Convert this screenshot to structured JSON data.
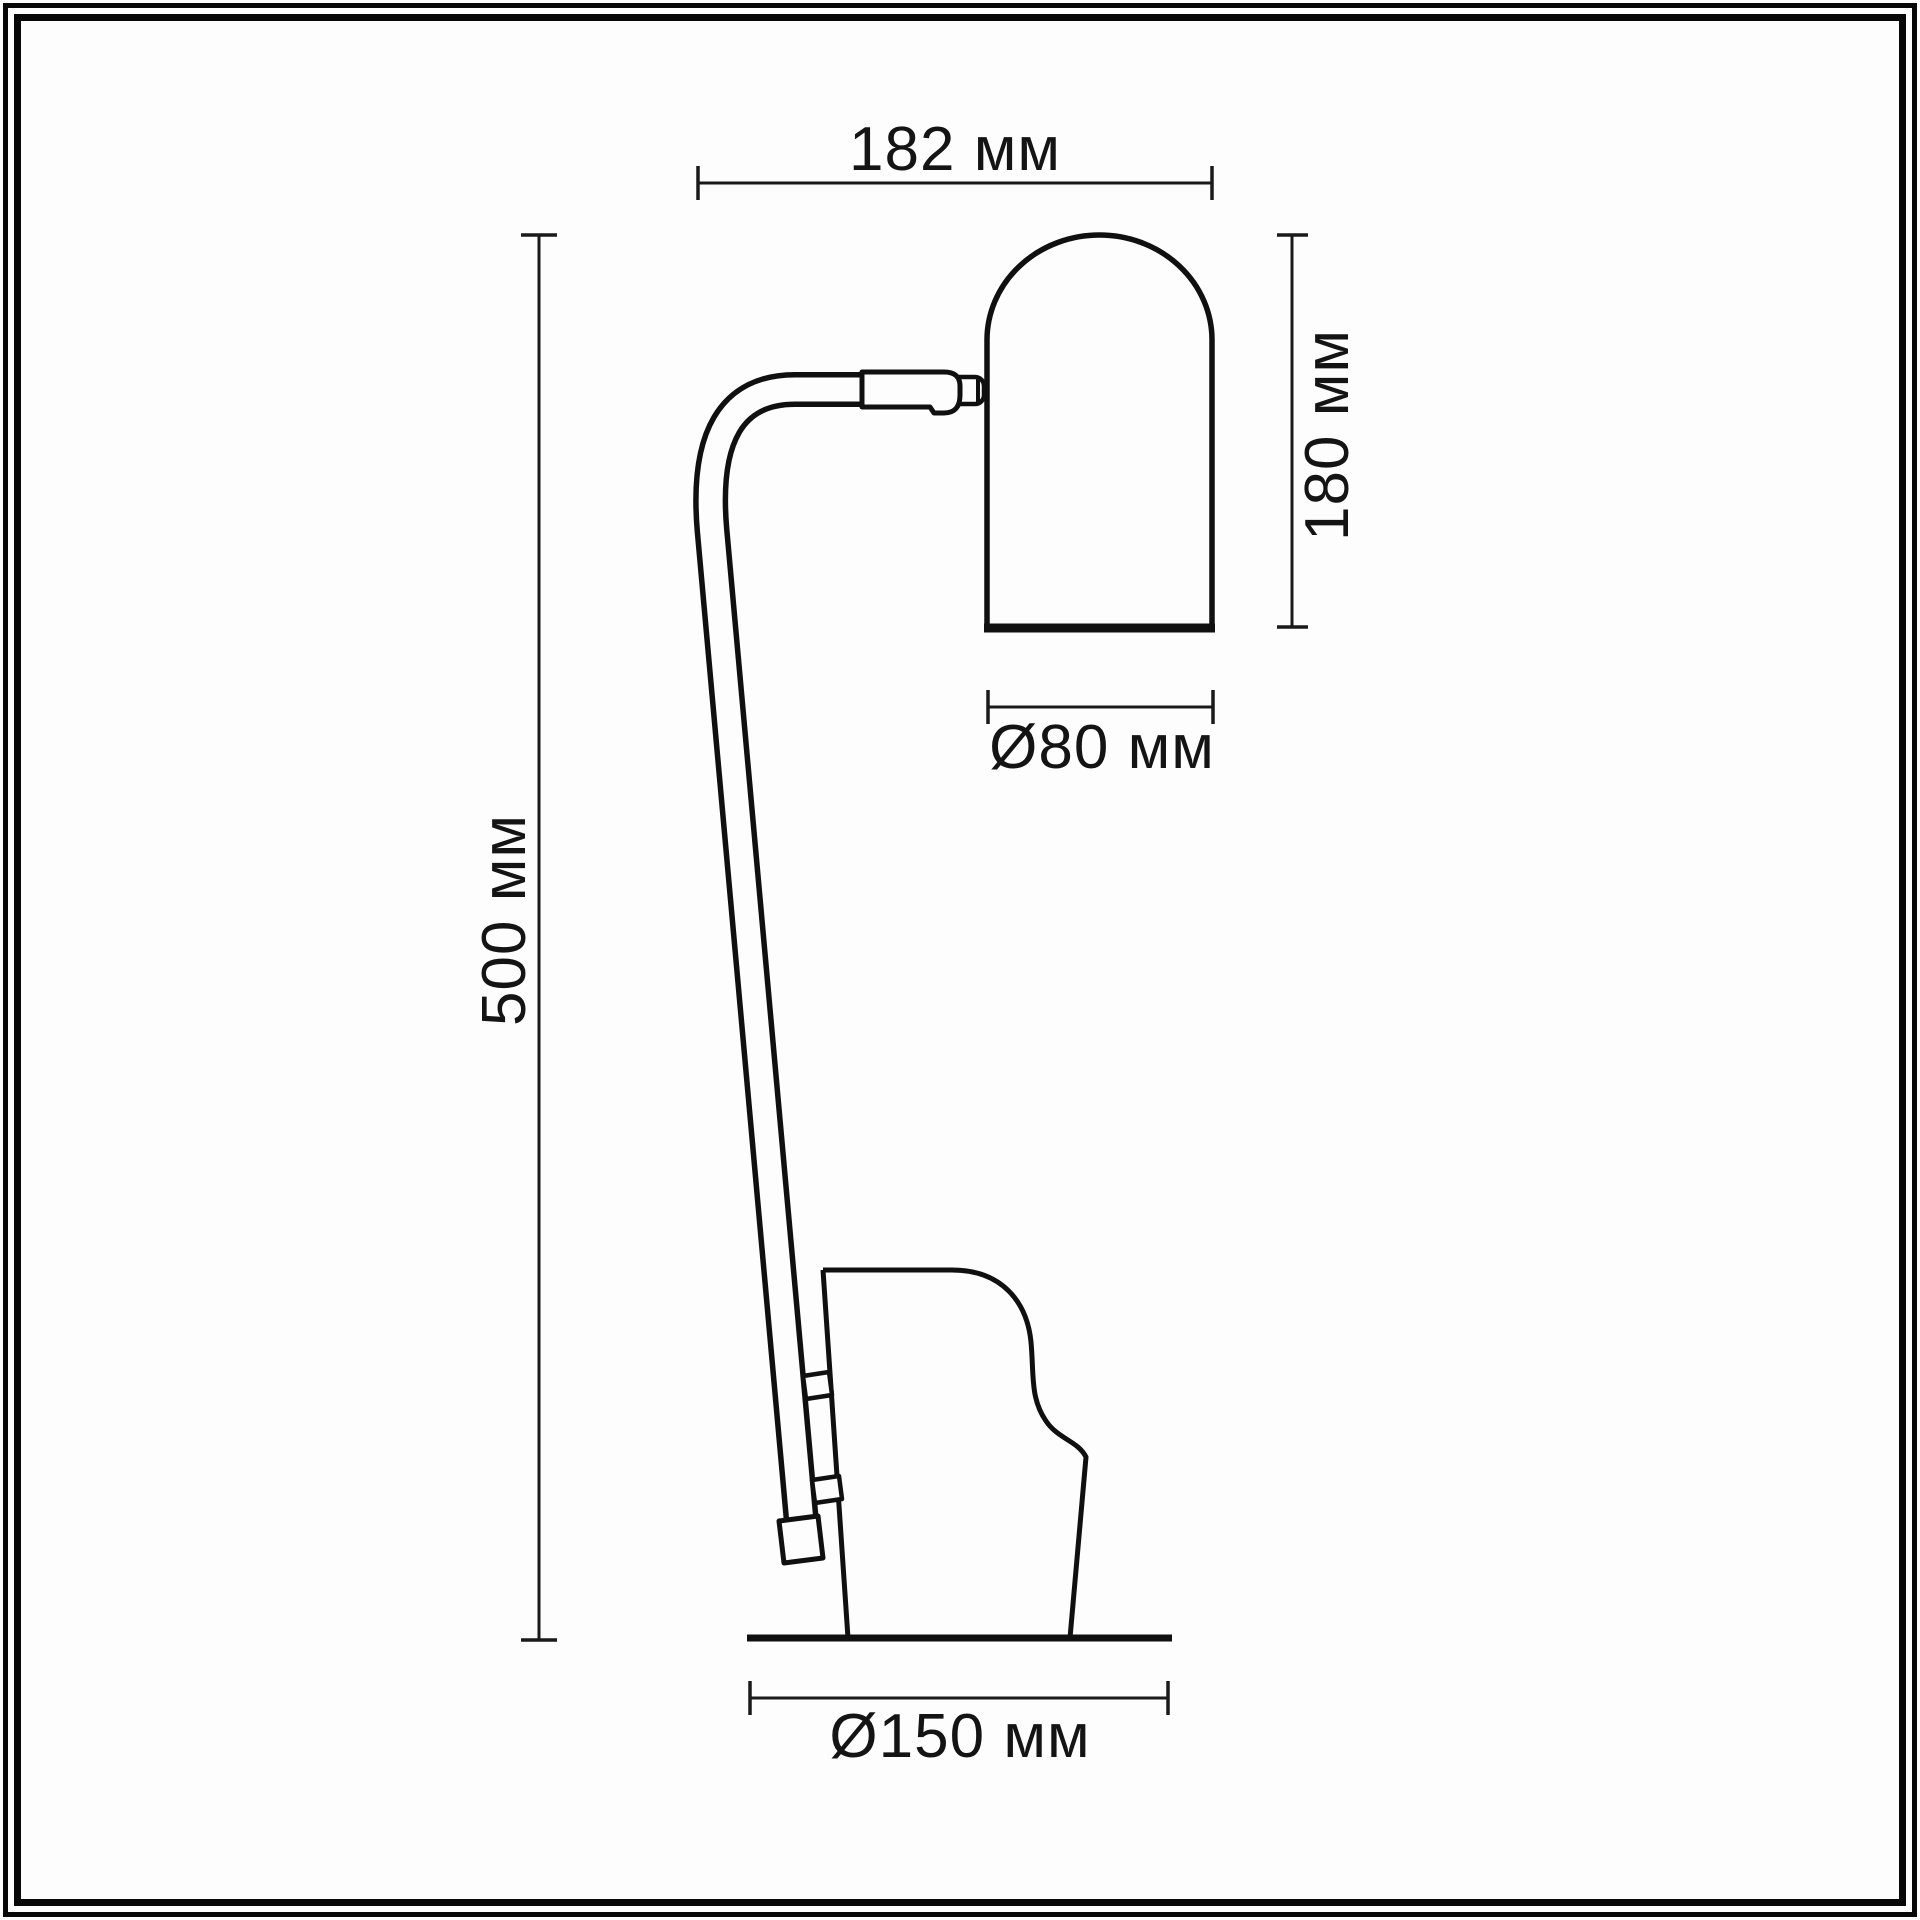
{
  "canvas": {
    "background": "#fdfdfd",
    "ink": "#141414",
    "frame_style": "double black border"
  },
  "subject": "table-lamp-side-view-line-drawing",
  "dimensions": {
    "overall_width": {
      "label": "182 мм",
      "orientation": "horizontal",
      "position": "top"
    },
    "shade_height": {
      "label": "180 мм",
      "orientation": "vertical",
      "position": "right-of-shade"
    },
    "shade_diameter": {
      "label": "Ø80 мм",
      "orientation": "horizontal",
      "position": "below-shade"
    },
    "overall_height": {
      "label": "500 мм",
      "orientation": "vertical",
      "position": "left"
    },
    "base_diameter": {
      "label": "Ø150 мм",
      "orientation": "horizontal",
      "position": "bottom"
    }
  },
  "parts": [
    "shade",
    "swivel-joint",
    "curved-arm",
    "stem",
    "stem-clamps",
    "stem-foot",
    "base",
    "ground-line"
  ]
}
